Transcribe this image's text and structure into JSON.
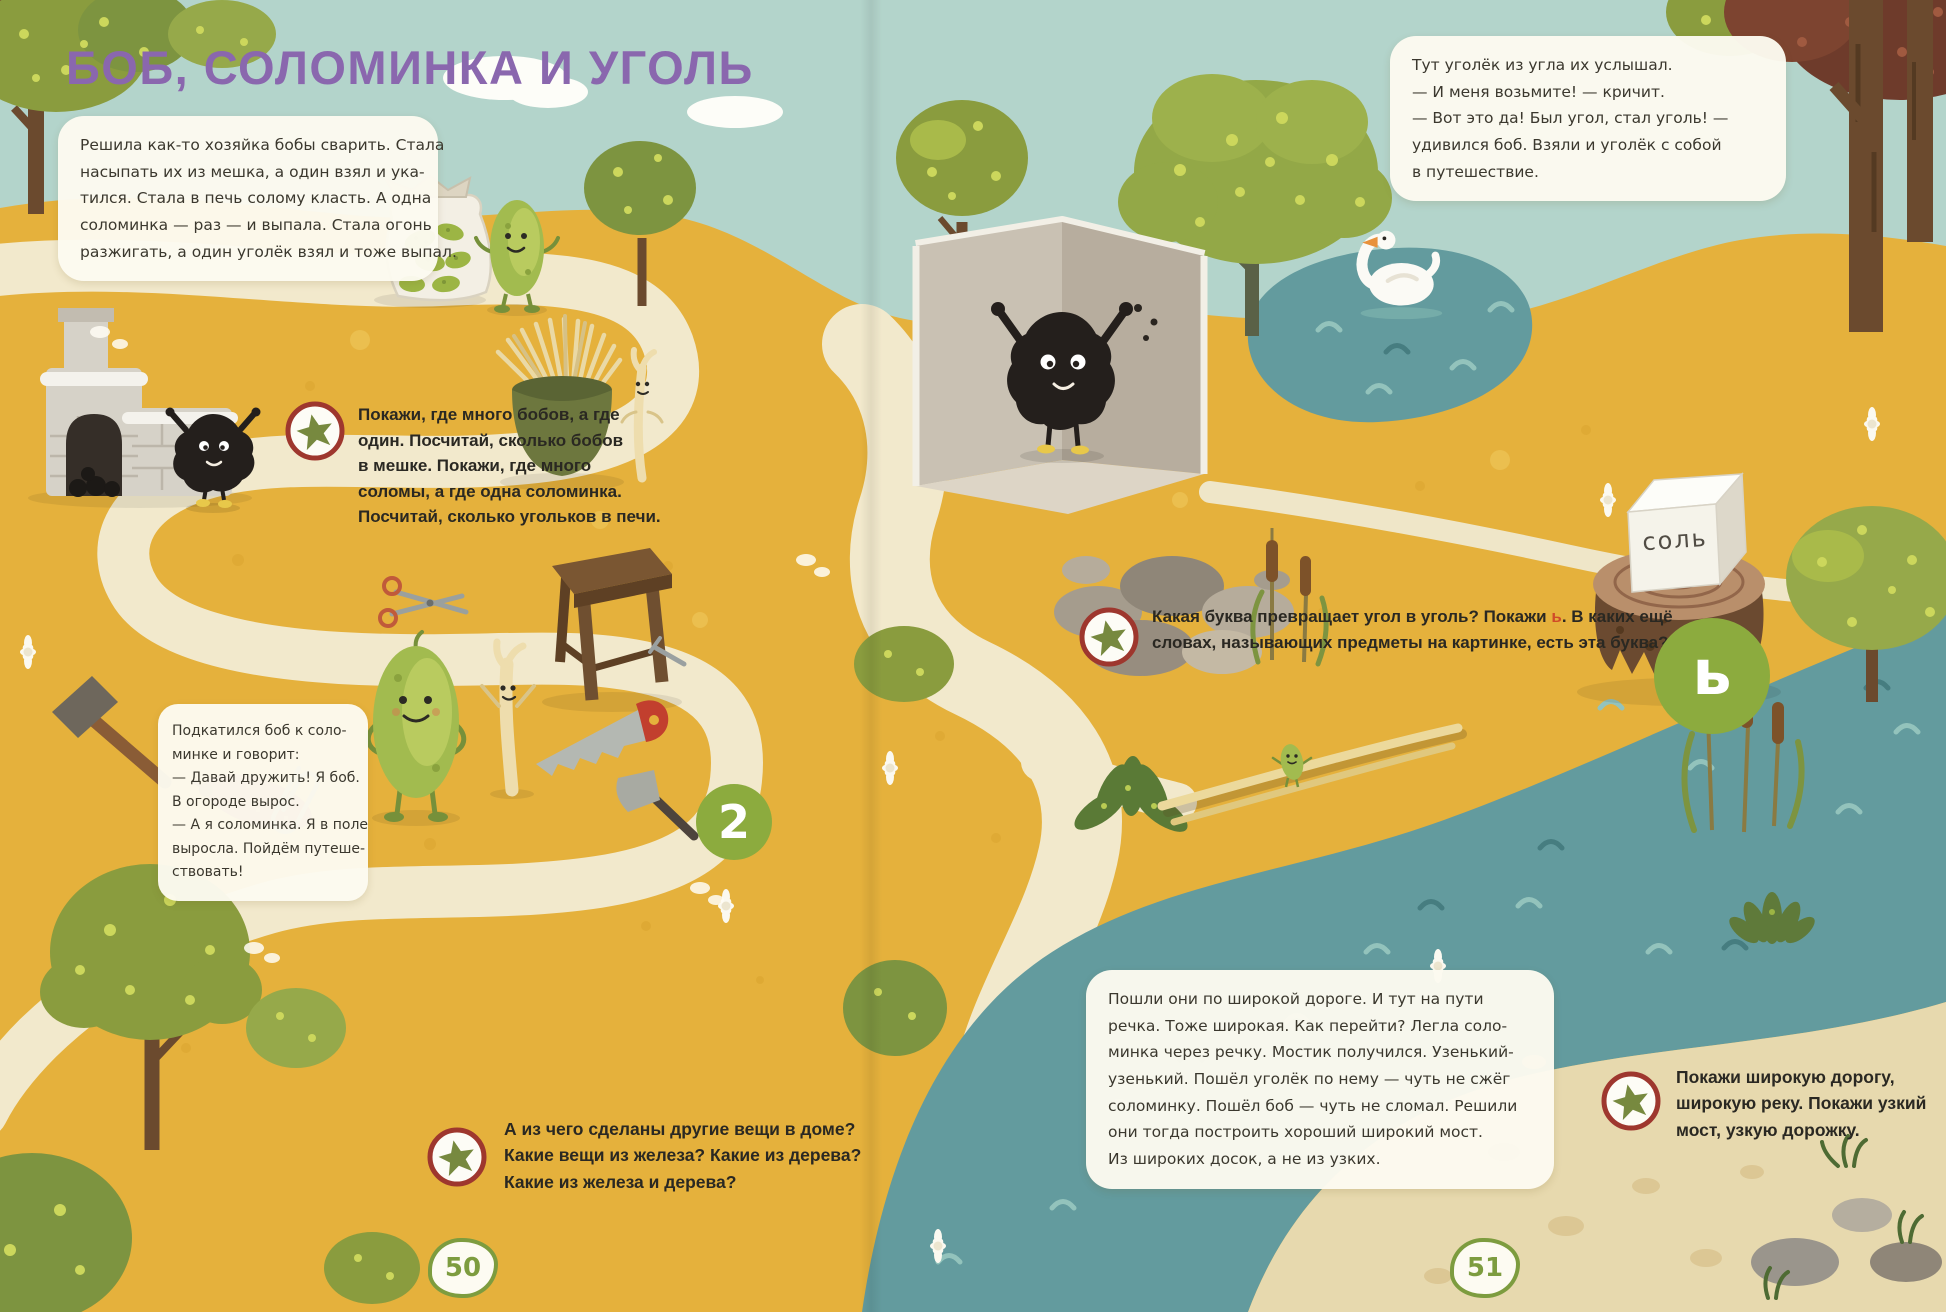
{
  "colors": {
    "sky": "#b3d4cb",
    "ground": "#e5b13c",
    "path": "#f2e9cc",
    "river": "#639b9e",
    "title_purple": "#8a67ae",
    "badge_green": "#8cab3e",
    "page_green": "#7d9c3f",
    "star_ring_red": "#9e372e",
    "star_green": "#77893f",
    "letter_red": "#d04b28",
    "box_bg": "#fcfaf0"
  },
  "title": "БОБ, СОЛОМИНКА И УГОЛЬ",
  "story": {
    "intro": "Решила как-то хозяйка бобы сварить. Стала\nнасыпать их из мешка, а один взял и ука-\nтился. Стала в печь солому класть. А одна\nсоломинка — раз — и выпала. Стала огонь\nразжигать, а один уголёк взял и тоже выпал.",
    "coal": "Тут уголёк из угла их услышал.\n— И меня возьмите! — кричит.\n— Вот это да! Был угол, стал уголь! —\nудивился боб. Взяли и уголёк с собой\nв путешествие.",
    "river": "Пошли они по широкой дороге. И тут на пути\nречка. Тоже широкая. Как перейти? Легла соло-\nминка через речку. Мостик получился. Узенький-\nузенький. Пошёл уголёк по нему — чуть не сжёг\nсоломинку. Пошёл боб — чуть не сломал. Решили\nони тогда построить хороший широкий мост.\nИз широких досок, а не из узких."
  },
  "speech_bubble": "Подкатился боб к соло-\nминке и говорит:\n— Давай дружить! Я боб.\nВ огороде вырос.\n— А я соломинка. Я в поле\nвыросла. Пойдём путеше-\nствовать!",
  "tasks": {
    "count": "Покажи, где много бобов, а где\nодин. Посчитай, сколько бобов\nв мешке. Покажи, где много\nсоломы, а где одна соломинка.\nПосчитай, сколько угольков в печи.",
    "letter_before": "Какая буква превращает угол в уголь? Покажи ",
    "letter_char": "ь",
    "letter_after": ". В каких ещё\nсловах, называющих предметы на картинке, есть эта буква?",
    "materials": "А из чего сделаны другие вещи в доме?\nКакие вещи из железа? Какие из дерева?\nКакие из железа и дерева?",
    "wide": "Покажи широкую дорогу,\nширокую реку. Покажи узкий\nмост, узкую дорожку."
  },
  "badges": {
    "number": "2",
    "letter": "ь"
  },
  "labels": {
    "salt": "соль"
  },
  "pages": {
    "left": "50",
    "right": "51"
  }
}
